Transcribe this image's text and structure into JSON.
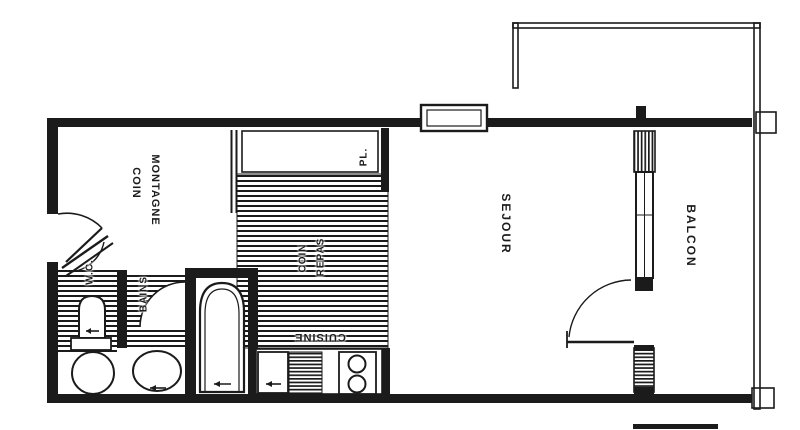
{
  "document": {
    "type": "apartment-floor-plan",
    "style": "black-and-white scanned architectural drawing"
  },
  "colors": {
    "ink": "#1b1b1b",
    "paper": "#ffffff"
  },
  "labels": {
    "coin_montagne_1": "COIN",
    "coin_montagne_2": "MONTAGNE",
    "placard": "PL.",
    "coin_repas_1": "COIN",
    "coin_repas_2": "REPAS",
    "cuisine": "CUISINE",
    "sejour": "SEJOUR",
    "balcon": "BALCON",
    "wc": "W.C.",
    "bains": "BAINS"
  }
}
